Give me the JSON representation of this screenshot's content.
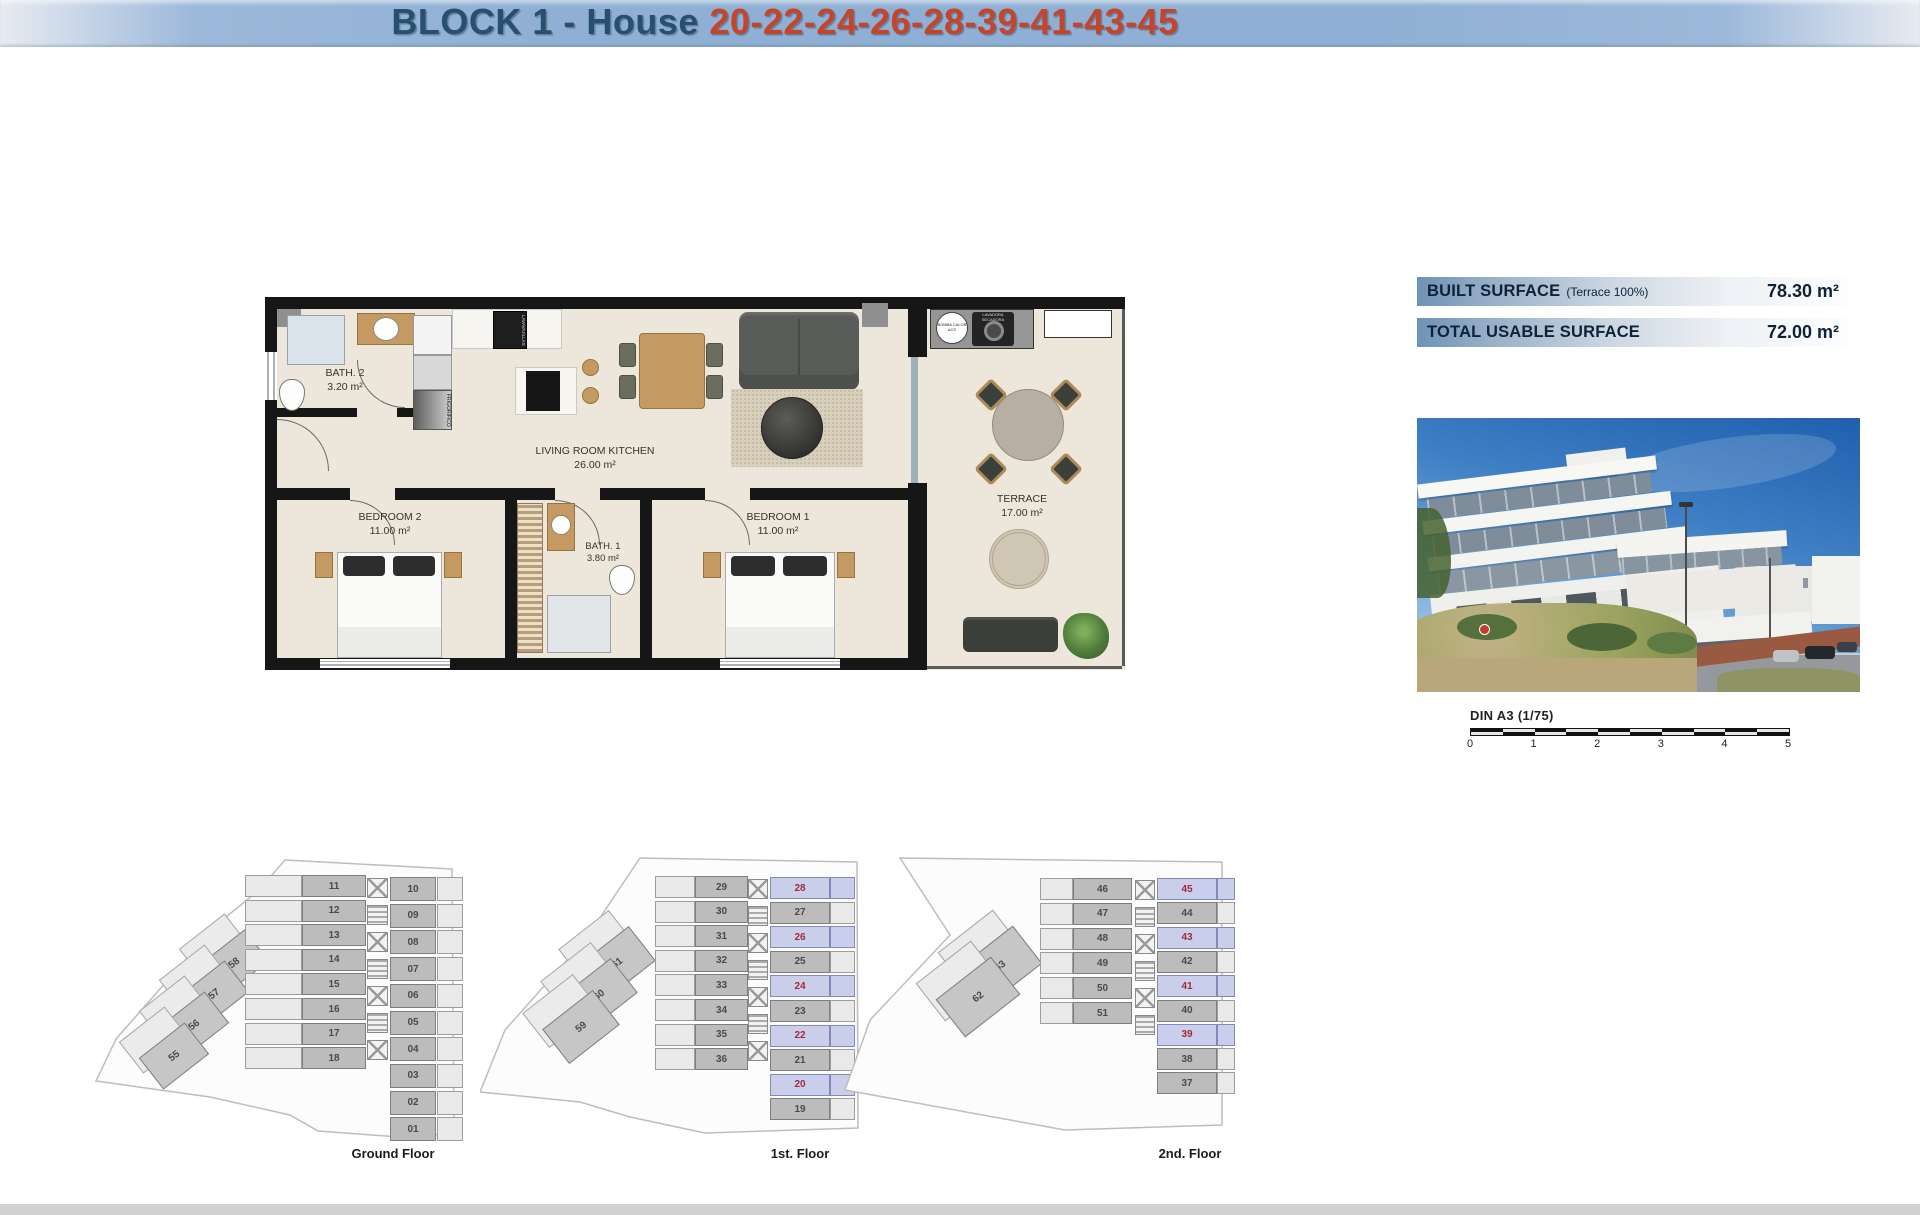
{
  "header": {
    "title_prefix": "BLOCK 1 - House ",
    "title_numbers": "20-22-24-26-28-39-41-43-45"
  },
  "colors": {
    "header_blue": "#8fb0d4",
    "title_blue": "#27506e",
    "title_red": "#c2452c",
    "highlight_bg": "#c9cfea",
    "highlight_number": "#a12b38"
  },
  "floorplan": {
    "rooms": [
      {
        "name": "BATH. 2",
        "area": "3.20 m²"
      },
      {
        "name": "LIVING ROOM KITCHEN",
        "area": "26.00 m²"
      },
      {
        "name": "BEDROOM 2",
        "area": "11.00 m²"
      },
      {
        "name": "BATH. 1",
        "area": "3.80 m²"
      },
      {
        "name": "BEDROOM 1",
        "area": "11.00 m²"
      },
      {
        "name": "TERRACE",
        "area": "17.00 m²"
      }
    ],
    "appliances": {
      "fridge": "FRIGORIFICO",
      "dishwasher": "LAVAVAJILLAS",
      "heat_pump": "BOMBA CALOR ACS",
      "washer": "LAVADORA SECADORA"
    }
  },
  "surface_table": {
    "rows": [
      {
        "label": "BUILT SURFACE",
        "note": "(Terrace 100%)",
        "value": "78.30 m²"
      },
      {
        "label": "TOTAL USABLE SURFACE",
        "note": "",
        "value": "72.00 m²"
      }
    ]
  },
  "scale_bar": {
    "label": "DIN A3 (1/75)",
    "ticks": [
      "0",
      "1",
      "2",
      "3",
      "4",
      "5"
    ]
  },
  "floors": [
    {
      "label": "Ground Floor",
      "left_units": [
        "11",
        "12",
        "13",
        "14",
        "15",
        "16",
        "17",
        "18"
      ],
      "right_units": [
        "10",
        "09",
        "08",
        "07",
        "06",
        "05",
        "04",
        "03",
        "02",
        "01"
      ],
      "wing_units": [
        "58",
        "57",
        "56",
        "55"
      ],
      "highlighted": []
    },
    {
      "label": "1st. Floor",
      "left_units": [
        "29",
        "30",
        "31",
        "32",
        "33",
        "34",
        "35",
        "36"
      ],
      "right_units": [
        "28",
        "27",
        "26",
        "25",
        "24",
        "23",
        "22",
        "21",
        "20",
        "19"
      ],
      "wing_units": [
        "61",
        "60",
        "59"
      ],
      "highlighted": [
        "28",
        "26",
        "24",
        "22",
        "20"
      ]
    },
    {
      "label": "2nd. Floor",
      "left_units": [
        "46",
        "47",
        "48",
        "49",
        "50",
        "51"
      ],
      "right_units": [
        "45",
        "44",
        "43",
        "42",
        "41",
        "40",
        "39",
        "38",
        "37"
      ],
      "wing_units": [
        "63",
        "62"
      ],
      "highlighted": [
        "45",
        "43",
        "41",
        "39"
      ]
    }
  ]
}
